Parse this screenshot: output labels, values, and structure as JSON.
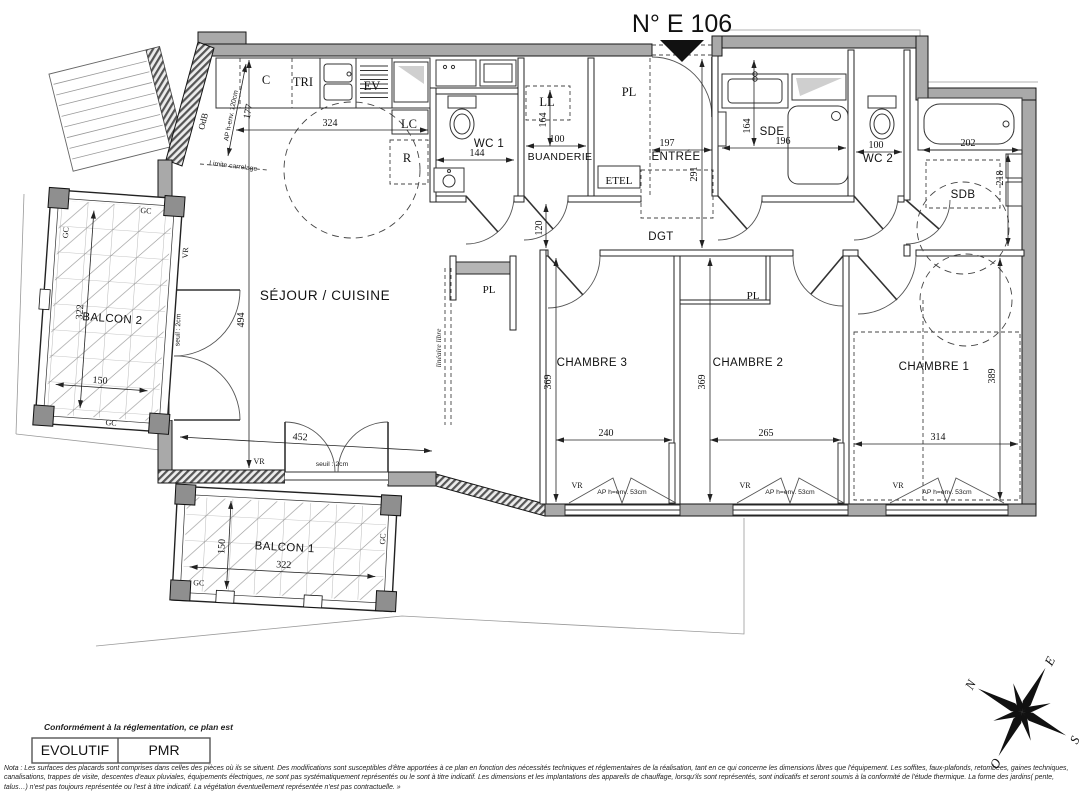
{
  "title": "N° E 106",
  "rooms": {
    "sejour": "SÉJOUR / CUISINE",
    "wc1": "WC 1",
    "buanderie": "BUANDERIE",
    "entree": "ENTRÉE",
    "dgt": "DGT",
    "sde": "SDE",
    "wc2": "WC 2",
    "sdb": "SDB",
    "ch1": "CHAMBRE 1",
    "ch2": "CHAMBRE 2",
    "ch3": "CHAMBRE 3",
    "balcon1": "BALCON 1",
    "balcon2": "BALCON 2"
  },
  "codes": {
    "c": "C",
    "tri": "TRI",
    "ev": "EV",
    "lc": "LC",
    "r": "R",
    "ll": "LL",
    "pl": "PL",
    "etel": "ETEL",
    "odb": "OdB",
    "vr": "VR",
    "gc": "GC"
  },
  "annotations": {
    "ap120": "AP h-env. 120cm",
    "ap53": "AP h=env. 53cm",
    "limite": "Limite carrelage",
    "lineaire": "linéaire libre",
    "seuil": "seuil : 2cm"
  },
  "dims": {
    "kitchen_clear": "177",
    "kitchen_w": "324",
    "wc1_w": "144",
    "buanderie_d": "164",
    "buanderie_w": "100",
    "entree_w": "197",
    "entree_l": "291",
    "sde_d": "164",
    "sde_w": "196",
    "wc2_w": "100",
    "sdb_w": "202",
    "sdb_d": "218",
    "dgt_w": "120",
    "sejour_l": "494",
    "sejour_w": "452",
    "ch3_l": "369",
    "ch3_w": "240",
    "ch2_l": "369",
    "ch2_w": "265",
    "ch1_l": "389",
    "ch1_w": "314",
    "balcon2_l": "322",
    "balcon2_w": "150",
    "balcon1_d": "150",
    "balcon1_w": "322"
  },
  "legend": {
    "conforme": "Conformément à la réglementation, ce plan est",
    "evolutif": "EVOLUTIF",
    "pmr": "PMR"
  },
  "compass": {
    "n": "N",
    "e": "E",
    "s": "S",
    "o": "O"
  },
  "note": {
    "text": "Nota : Les surfaces des placards sont comprises dans celles des pièces où ils se situent. Des modifications sont susceptibles d'être apportées à ce plan en fonction des nécessités techniques et réglementaires de la réalisation, tant en ce qui concerne les dimensions libres que l'équipement.  Les soffites, faux-plafonds, retombées, gaines techniques, canalisations, trappes de visite, descentes d'eaux pluviales, équipements électriques, ne sont pas systématiquement représentés ou le sont à titre indicatif. Les dimensions et les implantations des appareils de chauffage, lorsqu'ils sont représentés, sont indicatifs et seront soumis à la conformité de l'étude thermique. La forme des jardins( pente, talus…) n'est pas toujours représentée ou l'est à titre indicatif. La végétation éventuellement représentée n'est pas contractuelle. »"
  }
}
